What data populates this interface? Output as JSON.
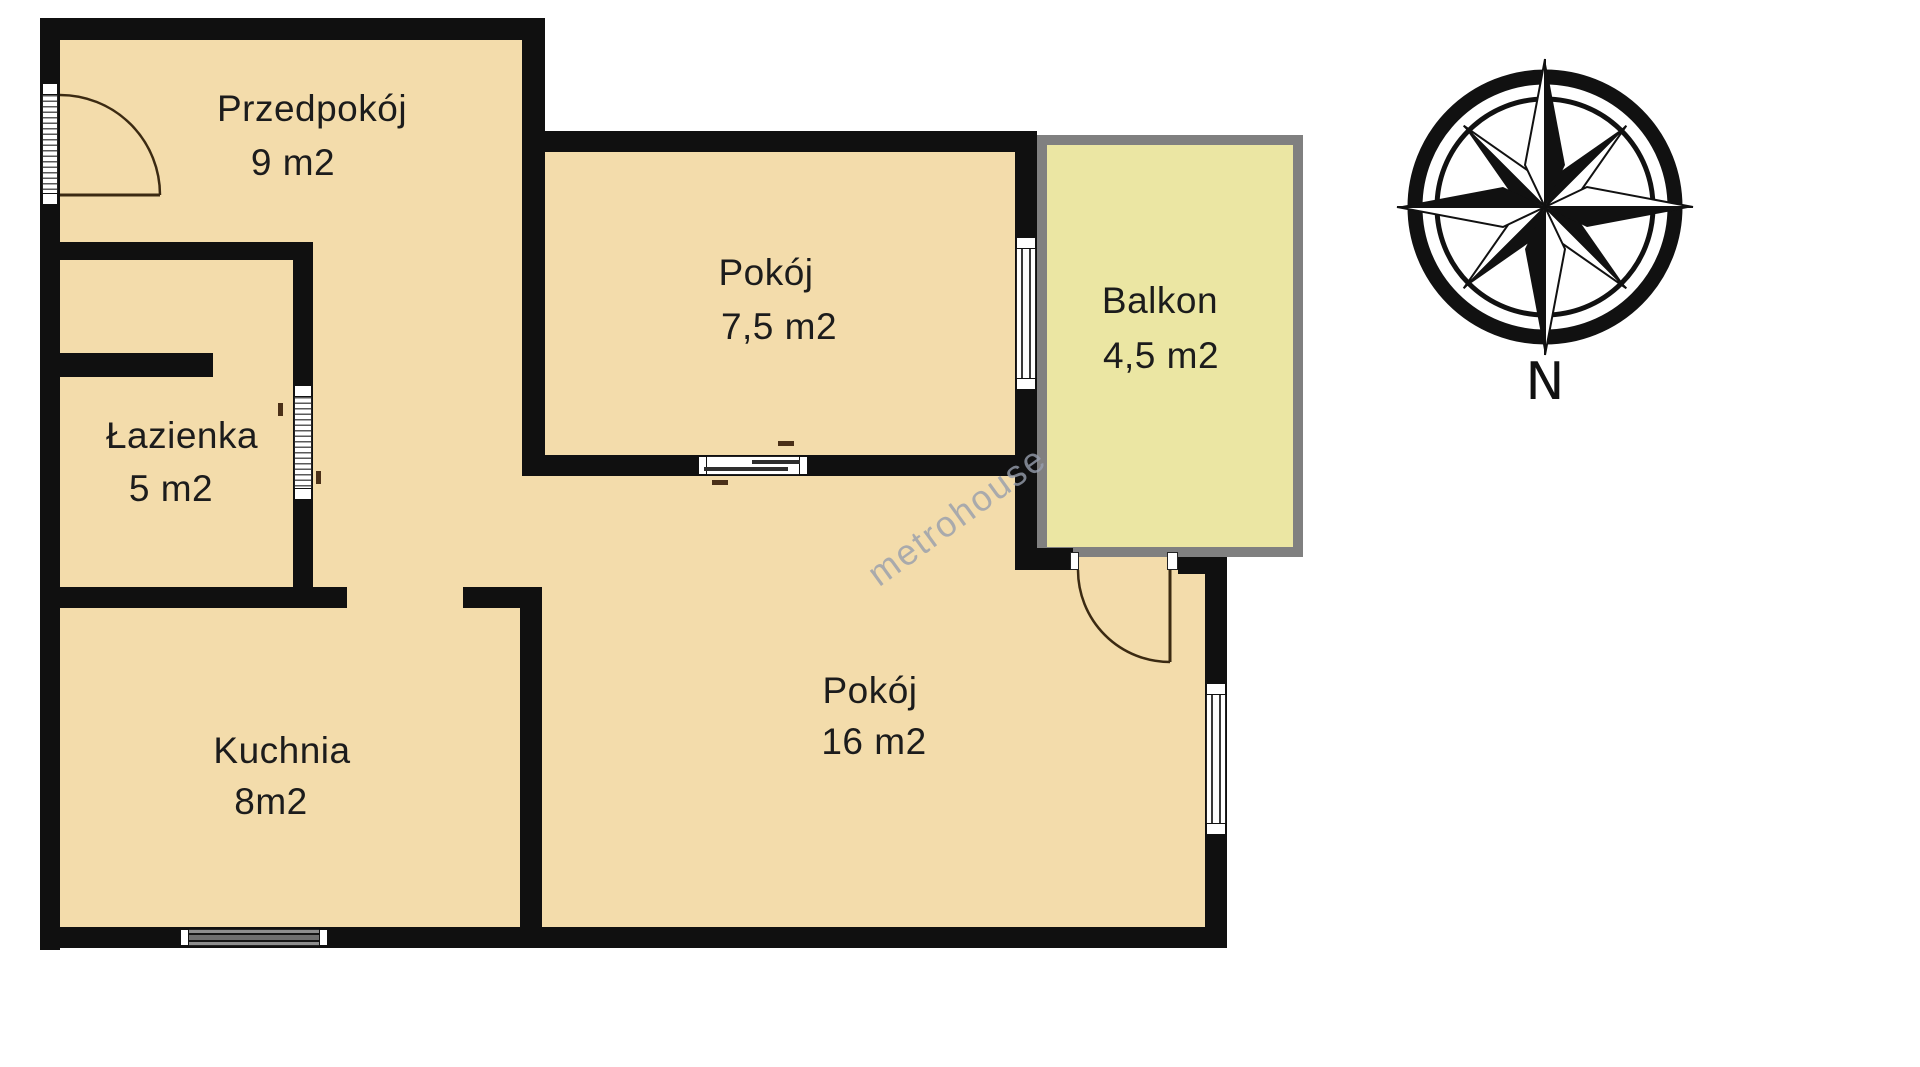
{
  "rooms": {
    "przedpokoj": {
      "name": "Przedpokój",
      "area": "9 m2"
    },
    "lazienka": {
      "name": "Łazienka",
      "area": "5 m2"
    },
    "kuchnia": {
      "name": "Kuchnia",
      "area": "8m2"
    },
    "pokoj_maly": {
      "name": "Pokój",
      "area": "7,5 m2"
    },
    "pokoj_duzy": {
      "name": "Pokój",
      "area": "16 m2"
    },
    "balkon": {
      "name": "Balkon",
      "area": "4,5 m2"
    }
  },
  "compass": {
    "north_label": "N"
  },
  "watermark": {
    "text": "metrohouse"
  },
  "colors": {
    "floor": "#f3dcab",
    "balcony_fill": "#ebe6a3",
    "balcony_border": "#808080",
    "wall": "#101010",
    "label": "#1c1c1c",
    "door": "#3b2a12"
  }
}
